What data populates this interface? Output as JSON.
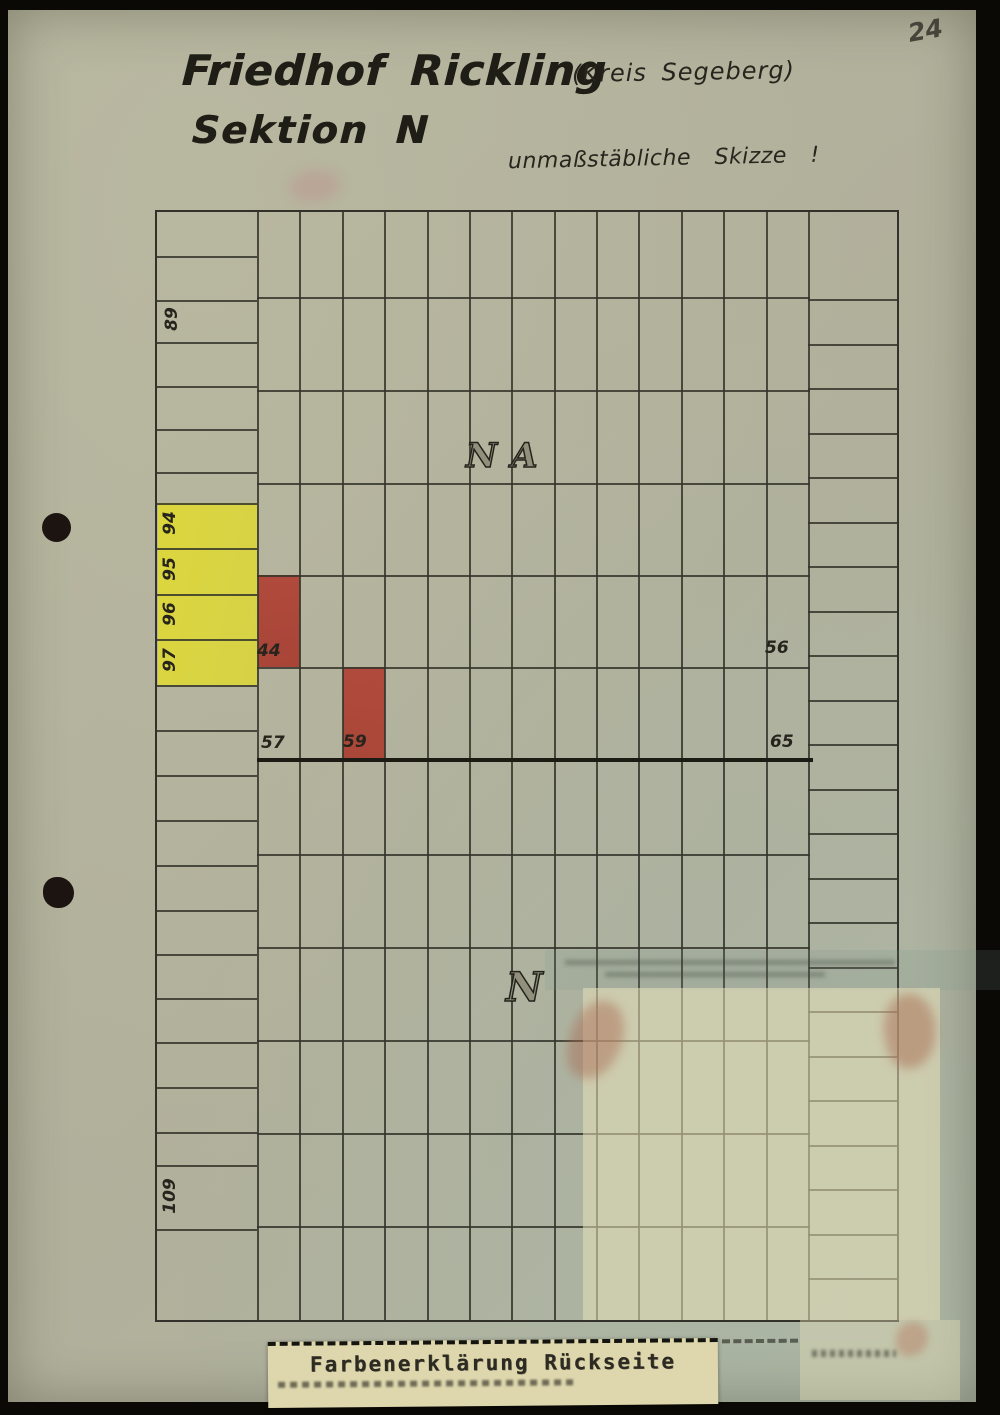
{
  "page": {
    "number": "24"
  },
  "header": {
    "title": "Friedhof Rickling",
    "district": "(Kreis Segeberg)",
    "section": "Sektion N",
    "note": "unmaßstäbliche Skizze !"
  },
  "area_labels": {
    "upper": "NA",
    "lower": "N"
  },
  "plot_labels": {
    "p89": "89",
    "p94": "94",
    "p95": "95",
    "p96": "96",
    "p97": "97",
    "p109": "109",
    "p44": "44",
    "p56": "56",
    "p57": "57",
    "p59": "59",
    "p65": "65"
  },
  "stamp": {
    "text": "Farbenerklärung Rückseite"
  },
  "colors": {
    "paper": "#b1b09b",
    "grid_line": "#35352b",
    "heavy_line": "#1b1b14",
    "highlight_yellow": "#dcd63d",
    "highlight_red": "#b04a3c",
    "stamp_paper": "#ded7ad"
  },
  "sketch": {
    "grid": {
      "w": 740,
      "h": 1108,
      "left_col_w": 100,
      "right_col_x": 651,
      "main_cols": 13,
      "main_row_ys": [
        85,
        178,
        271,
        363,
        455,
        642,
        735,
        828,
        921,
        1014
      ],
      "left_row_ys": [
        44,
        88,
        130,
        174,
        217,
        260,
        291,
        336,
        382,
        427,
        473,
        518,
        563,
        608,
        653,
        698,
        742,
        786,
        830,
        875,
        920,
        953,
        1017
      ],
      "right_row_ys": [
        87,
        132,
        176,
        221,
        265,
        310,
        354,
        399,
        443,
        488,
        532,
        577,
        621,
        666,
        710,
        755,
        799,
        844,
        888,
        933,
        977,
        1022,
        1066
      ],
      "heavy_row_y": 546
    }
  }
}
